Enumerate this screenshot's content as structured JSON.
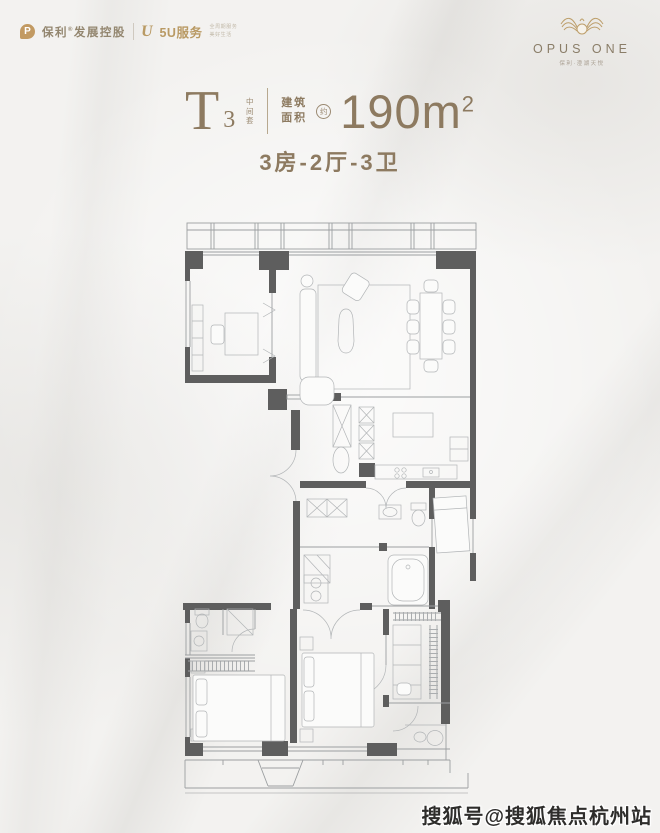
{
  "header": {
    "brand_left": {
      "poly_icon": "P",
      "poly_name": "保利",
      "reg_mark": "®",
      "poly_suffix": "发展控股",
      "service_icon": "U",
      "service_name": "5U服务",
      "service_tagline_1": "全周期服务",
      "service_tagline_2": "美好生活"
    },
    "brand_right": {
      "logo_icon": "gold-wings-emblem",
      "name": "OPUS ONE",
      "subtitle": "保利·澄湖天悦"
    }
  },
  "title": {
    "unit_letter": "T",
    "unit_number": "3",
    "unit_tag": "中间套",
    "area_label_1": "建筑",
    "area_label_2": "面积",
    "area_approx": "约",
    "area_value": "190m",
    "area_exponent": "2",
    "layout_text": "3房-2厅-3卫"
  },
  "floor_plan": {
    "kind": "apartment-unit-plan",
    "unit": "T3",
    "gross_area_sqm": 190,
    "bedrooms": 3,
    "living_rooms": 2,
    "bathrooms": 3
  },
  "watermark": {
    "text": "搜狐号@搜狐焦点杭州站"
  },
  "colors": {
    "accent_brown": "#8d7a60",
    "brand_gold": "#b99a64",
    "wall_dark": "#5e5e5e",
    "line_gray": "#9c9fa1",
    "furniture_gray": "#b2b5b7",
    "watermark_ink": "#2e2d2b",
    "background": "#f3f2f0"
  }
}
